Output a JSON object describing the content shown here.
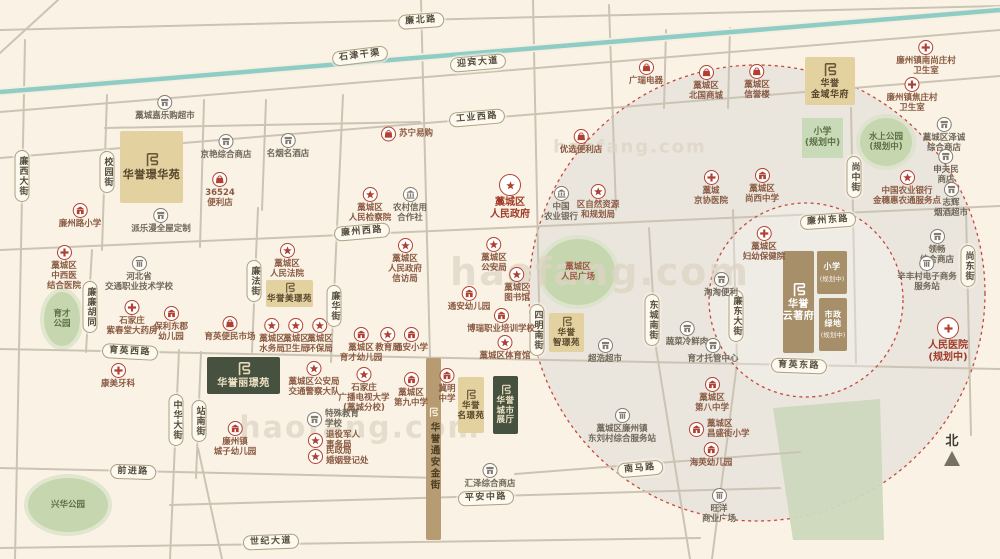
{
  "north_label": "北",
  "watermark": "haofang.com",
  "canal": {
    "label": "石津干渠",
    "x": 360,
    "y": 56,
    "rot": -7,
    "line": [
      0,
      92,
      1000,
      10
    ]
  },
  "colors": {
    "bg": "#faf3e5",
    "road": "#cbc4b4",
    "canal": "#8fccc6",
    "park": "#c6d7b0",
    "accent_red": "#b2402f",
    "icon_gray": "#837b6c",
    "gold": "#e4d1a0",
    "dark_green": "#475140",
    "brown": "#a78f69",
    "circle_fill": "#e6e2da",
    "circle_stroke": "#c8473a"
  },
  "circles": {
    "big": {
      "cx": 757,
      "cy": 293,
      "r": 228
    },
    "small": {
      "cx": 806,
      "cy": 300,
      "r": 97
    }
  },
  "road_lines": [
    [
      0,
      30,
      1000,
      6
    ],
    [
      0,
      112,
      1000,
      30
    ],
    [
      0,
      158,
      1000,
      76
    ],
    [
      0,
      250,
      1000,
      206
    ],
    [
      0,
      349,
      1000,
      369
    ],
    [
      0,
      468,
      440,
      478
    ],
    [
      170,
      505,
      780,
      488
    ],
    [
      0,
      548,
      700,
      538
    ],
    [
      515,
      474,
      800,
      452
    ],
    [
      105,
      128,
      420,
      122
    ],
    [
      58,
      0,
      0,
      53
    ],
    [
      25,
      40,
      15,
      559
    ],
    [
      107,
      95,
      102,
      250
    ],
    [
      92,
      250,
      86,
      352
    ],
    [
      204,
      100,
      200,
      247
    ],
    [
      266,
      100,
      262,
      210
    ],
    [
      343,
      95,
      331,
      362
    ],
    [
      258,
      208,
      252,
      352
    ],
    [
      179,
      350,
      170,
      559
    ],
    [
      201,
      352,
      196,
      478
    ],
    [
      198,
      448,
      222,
      559
    ],
    [
      421,
      0,
      430,
      358
    ],
    [
      533,
      0,
      540,
      350
    ],
    [
      609,
      5,
      616,
      210
    ],
    [
      649,
      228,
      656,
      348
    ],
    [
      656,
      348,
      690,
      559
    ],
    [
      733,
      210,
      737,
      363
    ],
    [
      737,
      363,
      712,
      559
    ],
    [
      851,
      108,
      856,
      363
    ],
    [
      966,
      210,
      971,
      435
    ],
    [
      666,
      30,
      664,
      108
    ],
    [
      730,
      28,
      728,
      108
    ]
  ],
  "road_pills_h": [
    {
      "t": "廉北路",
      "x": 421,
      "y": 21,
      "r": -4
    },
    {
      "t": "迎宾大道",
      "x": 478,
      "y": 63,
      "r": -5
    },
    {
      "t": "工业西路",
      "x": 477,
      "y": 118,
      "r": -5
    },
    {
      "t": "廉州西路",
      "x": 362,
      "y": 232,
      "r": -5
    },
    {
      "t": "廉州东路",
      "x": 828,
      "y": 221,
      "r": -4
    },
    {
      "t": "育英西路",
      "x": 130,
      "y": 352,
      "r": 3
    },
    {
      "t": "育英东路",
      "x": 799,
      "y": 366,
      "r": 2
    },
    {
      "t": "前进路",
      "x": 133,
      "y": 472,
      "r": 2
    },
    {
      "t": "南马路",
      "x": 640,
      "y": 469,
      "r": -5
    },
    {
      "t": "平安中路",
      "x": 486,
      "y": 498,
      "r": -2
    },
    {
      "t": "世纪大道",
      "x": 271,
      "y": 542,
      "r": -2
    }
  ],
  "road_pills_v": [
    {
      "t": "廉西大街",
      "x": 22,
      "y": 176
    },
    {
      "t": "校园街",
      "x": 107,
      "y": 172
    },
    {
      "t": "廉廉胡同",
      "x": 90,
      "y": 307
    },
    {
      "t": "廉法街",
      "x": 254,
      "y": 281
    },
    {
      "t": "廉华街",
      "x": 334,
      "y": 306
    },
    {
      "t": "中华大街",
      "x": 176,
      "y": 420
    },
    {
      "t": "站南街",
      "x": 199,
      "y": 421
    },
    {
      "t": "四明南街",
      "x": 537,
      "y": 330
    },
    {
      "t": "东城南街",
      "x": 652,
      "y": 320
    },
    {
      "t": "廉东大街",
      "x": 736,
      "y": 316
    },
    {
      "t": "尚中街",
      "x": 854,
      "y": 177
    },
    {
      "t": "尚东街",
      "x": 968,
      "y": 266
    }
  ],
  "parks": [
    {
      "label": "育才\n公园",
      "cx": 62,
      "cy": 319,
      "rx": 18,
      "ry": 27
    },
    {
      "label": "兴华公园",
      "cx": 68,
      "cy": 505,
      "rx": 40,
      "ry": 27
    },
    {
      "label": "藁城区\n人民广场",
      "cx": 578,
      "cy": 272,
      "rx": 37,
      "ry": 33,
      "lc": "#9c5844"
    },
    {
      "label": "水上公园\n(规划中)",
      "cx": 886,
      "cy": 142,
      "rx": 26,
      "ry": 24
    }
  ],
  "park_rect": {
    "label": "小学",
    "sub": "(规划中)",
    "x": 802,
    "y": 118,
    "w": 41,
    "h": 40
  },
  "green_zone": "773,408 880,399 884,540 793,540",
  "projects": [
    {
      "name": "华誉璟华苑",
      "style": "gold",
      "x": 120,
      "y": 131,
      "w": 63,
      "h": 72,
      "fs": 11
    },
    {
      "name": "华誉\n金域华府",
      "style": "gold",
      "x": 805,
      "y": 57,
      "w": 50,
      "h": 48,
      "fs": 9
    },
    {
      "name": "华誉美璟苑",
      "style": "gold",
      "x": 266,
      "y": 280,
      "w": 47,
      "h": 27,
      "fs": 8.5,
      "small": 1
    },
    {
      "name": "华誉丽璟苑",
      "style": "green",
      "x": 207,
      "y": 357,
      "w": 73,
      "h": 37,
      "fs": 10
    },
    {
      "name": "华誉\n名璟苑",
      "style": "gold",
      "x": 458,
      "y": 377,
      "w": 26,
      "h": 56,
      "fs": 8.5,
      "small": 1
    },
    {
      "name": "华誉\n城市\n展厅",
      "style": "green",
      "x": 493,
      "y": 376,
      "w": 25,
      "h": 58,
      "fs": 8.5,
      "small": 1
    },
    {
      "name": "华誉\n智璟苑",
      "style": "gold",
      "x": 549,
      "y": 313,
      "w": 35,
      "h": 39,
      "fs": 8.5,
      "small": 1
    },
    {
      "name": "华誉\n云著府",
      "style": "brown",
      "x": 783,
      "y": 251,
      "w": 31,
      "h": 102,
      "fs": 10
    },
    {
      "name": "小学",
      "sub": "(规划中)",
      "style": "brown",
      "x": 817,
      "y": 251,
      "w": 30,
      "h": 43,
      "fs": 8,
      "nologo": 1
    },
    {
      "name": "市政\n绿地",
      "sub": "(规划中)",
      "style": "brown",
      "x": 819,
      "y": 298,
      "w": 28,
      "h": 53,
      "fs": 8,
      "nologo": 1
    }
  ],
  "gold_street": {
    "name": "华誉通安金街",
    "x": 426,
    "y": 358,
    "w": 15,
    "h": 182
  },
  "pois": [
    {
      "x": 165,
      "y": 101,
      "i": "shop",
      "l": "藁城嘉乐购超市"
    },
    {
      "x": 226,
      "y": 140,
      "i": "shop",
      "l": "京艳综合商店"
    },
    {
      "x": 288,
      "y": 139,
      "i": "shop",
      "l": "名烟名酒店"
    },
    {
      "x": 220,
      "y": 178,
      "i": "bag",
      "l": "36524\n便利店"
    },
    {
      "x": 381,
      "y": 134,
      "i": "bag",
      "l": "苏宁易购",
      "p": "r"
    },
    {
      "x": 581,
      "y": 135,
      "i": "bag",
      "l": "优选便利店"
    },
    {
      "x": 646,
      "y": 66,
      "i": "bag",
      "l": "广瑞电器"
    },
    {
      "x": 706,
      "y": 71,
      "i": "bag",
      "l": "藁城区\n北国商城"
    },
    {
      "x": 757,
      "y": 70,
      "i": "bag",
      "l": "藁城区\n信誉楼"
    },
    {
      "x": 926,
      "y": 46,
      "i": "cross",
      "l": "廉州镇南尚庄村\n卫生室"
    },
    {
      "x": 912,
      "y": 83,
      "i": "cross",
      "l": "廉州镇焦庄村\n卫生室"
    },
    {
      "x": 944,
      "y": 123,
      "i": "shop",
      "l": "藁城区泽诚\n综合商店"
    },
    {
      "x": 946,
      "y": 155,
      "i": "shop",
      "l": "申夫民\n商店"
    },
    {
      "x": 951,
      "y": 188,
      "i": "shop",
      "l": "志辉\n烟酒超市"
    },
    {
      "x": 937,
      "y": 235,
      "i": "shop",
      "l": "领畅\n综合商店"
    },
    {
      "x": 927,
      "y": 262,
      "i": "info",
      "l": "辛丰村电子商务\n服务站"
    },
    {
      "x": 948,
      "y": 327,
      "i": "cross",
      "l": "人民医院\n(规划中)",
      "big": 1
    },
    {
      "x": 711,
      "y": 176,
      "i": "cross",
      "l": "藁城\n京协医院"
    },
    {
      "x": 762,
      "y": 174,
      "i": "school",
      "l": "藁城区\n尚西中学"
    },
    {
      "x": 907,
      "y": 176,
      "i": "star",
      "l": "中国农业银行\n金穗惠农通服务点"
    },
    {
      "x": 80,
      "y": 209,
      "i": "school",
      "l": "廉州路小学"
    },
    {
      "x": 161,
      "y": 214,
      "i": "shop",
      "l": "派乐漫全屋定制"
    },
    {
      "x": 64,
      "y": 251,
      "i": "cross",
      "l": "藁城区\n中西医\n结合医院"
    },
    {
      "x": 139,
      "y": 262,
      "i": "info",
      "l": "河北省\n交通职业技术学校"
    },
    {
      "x": 132,
      "y": 306,
      "i": "cross",
      "l": "石家庄\n紫春堂大药房"
    },
    {
      "x": 171,
      "y": 312,
      "i": "school",
      "l": "保利东郡\n幼儿园"
    },
    {
      "x": 230,
      "y": 322,
      "i": "bag",
      "l": "育英便民市场"
    },
    {
      "x": 118,
      "y": 369,
      "i": "cross",
      "l": "康美牙科"
    },
    {
      "x": 235,
      "y": 427,
      "i": "school",
      "l": "廉州镇\n城子幼儿园"
    },
    {
      "x": 287,
      "y": 249,
      "i": "star",
      "l": "藁城区\n人民法院"
    },
    {
      "x": 370,
      "y": 193,
      "i": "star",
      "l": "藁城区\n人民检察院"
    },
    {
      "x": 410,
      "y": 193,
      "i": "bank",
      "l": "农村信用\n合作社"
    },
    {
      "x": 510,
      "y": 184,
      "i": "star",
      "l": "藁城区\n人民政府",
      "big": 1
    },
    {
      "x": 405,
      "y": 244,
      "i": "star",
      "l": "藁城区\n人民政府\n信访局"
    },
    {
      "x": 494,
      "y": 243,
      "i": "star",
      "l": "藁城区\n公安局"
    },
    {
      "x": 517,
      "y": 273,
      "i": "star",
      "l": "藁城区\n图书馆"
    },
    {
      "x": 469,
      "y": 292,
      "i": "school",
      "l": "通安幼儿园"
    },
    {
      "x": 561,
      "y": 192,
      "i": "bank",
      "l": "中国\n农业银行"
    },
    {
      "x": 598,
      "y": 190,
      "i": "star",
      "l": "区自然资源\n和规划局"
    },
    {
      "x": 272,
      "y": 324,
      "i": "star",
      "l": "藁城区\n水务局"
    },
    {
      "x": 296,
      "y": 324,
      "i": "star",
      "l": "藁城区\n卫生局"
    },
    {
      "x": 320,
      "y": 324,
      "i": "star",
      "l": "藁城区\n环保局"
    },
    {
      "x": 361,
      "y": 333,
      "i": "school",
      "l": "藁城区\n育才幼儿园"
    },
    {
      "x": 388,
      "y": 333,
      "i": "star",
      "l": "教育局"
    },
    {
      "x": 411,
      "y": 333,
      "i": "school",
      "l": "通安小学"
    },
    {
      "x": 314,
      "y": 367,
      "i": "star",
      "l": "藁城区公安局\n交通警察大队"
    },
    {
      "x": 364,
      "y": 373,
      "i": "star",
      "l": "石家庄\n广播电视大学\n(藁城分校)"
    },
    {
      "x": 411,
      "y": 378,
      "i": "school",
      "l": "藁城区\n第九中学"
    },
    {
      "x": 447,
      "y": 374,
      "i": "school",
      "l": "冀明\n中学"
    },
    {
      "x": 307,
      "y": 419,
      "i": "shop",
      "l": "特殊教育\n学校",
      "p": "r"
    },
    {
      "x": 308,
      "y": 440,
      "i": "star",
      "l": "退役军人\n事务局",
      "p": "r"
    },
    {
      "x": 308,
      "y": 456,
      "i": "star",
      "l": "民政局\n婚姻登记处",
      "p": "r"
    },
    {
      "x": 501,
      "y": 314,
      "i": "school",
      "l": "博瑞职业培训学校"
    },
    {
      "x": 505,
      "y": 341,
      "i": "star",
      "l": "藁城区体育馆"
    },
    {
      "x": 605,
      "y": 344,
      "i": "shop",
      "l": "超浩超市"
    },
    {
      "x": 687,
      "y": 327,
      "i": "shop",
      "l": "蔬菜冷鲜肉"
    },
    {
      "x": 721,
      "y": 278,
      "i": "shop",
      "l": "淘淘便利"
    },
    {
      "x": 713,
      "y": 344,
      "i": "shop",
      "l": "育才托管中心"
    },
    {
      "x": 764,
      "y": 232,
      "i": "cross",
      "l": "藁城区\n妇幼保健院"
    },
    {
      "x": 622,
      "y": 414,
      "i": "info",
      "l": "藁城区廉州镇\n东刘村综合服务站"
    },
    {
      "x": 490,
      "y": 469,
      "i": "shop",
      "l": "汇泽综合商店"
    },
    {
      "x": 712,
      "y": 383,
      "i": "school",
      "l": "藁城区\n第八中学"
    },
    {
      "x": 689,
      "y": 429,
      "i": "school",
      "l": "藁城区\n昌盛街小学",
      "p": "r"
    },
    {
      "x": 711,
      "y": 448,
      "i": "school",
      "l": "海英幼儿园"
    },
    {
      "x": 719,
      "y": 494,
      "i": "info",
      "l": "旺洋\n商业广场"
    }
  ],
  "watermarks": [
    {
      "x": 360,
      "y": 428,
      "s": 30
    },
    {
      "x": 600,
      "y": 272,
      "s": 38
    },
    {
      "x": 630,
      "y": 147,
      "s": 18
    }
  ]
}
